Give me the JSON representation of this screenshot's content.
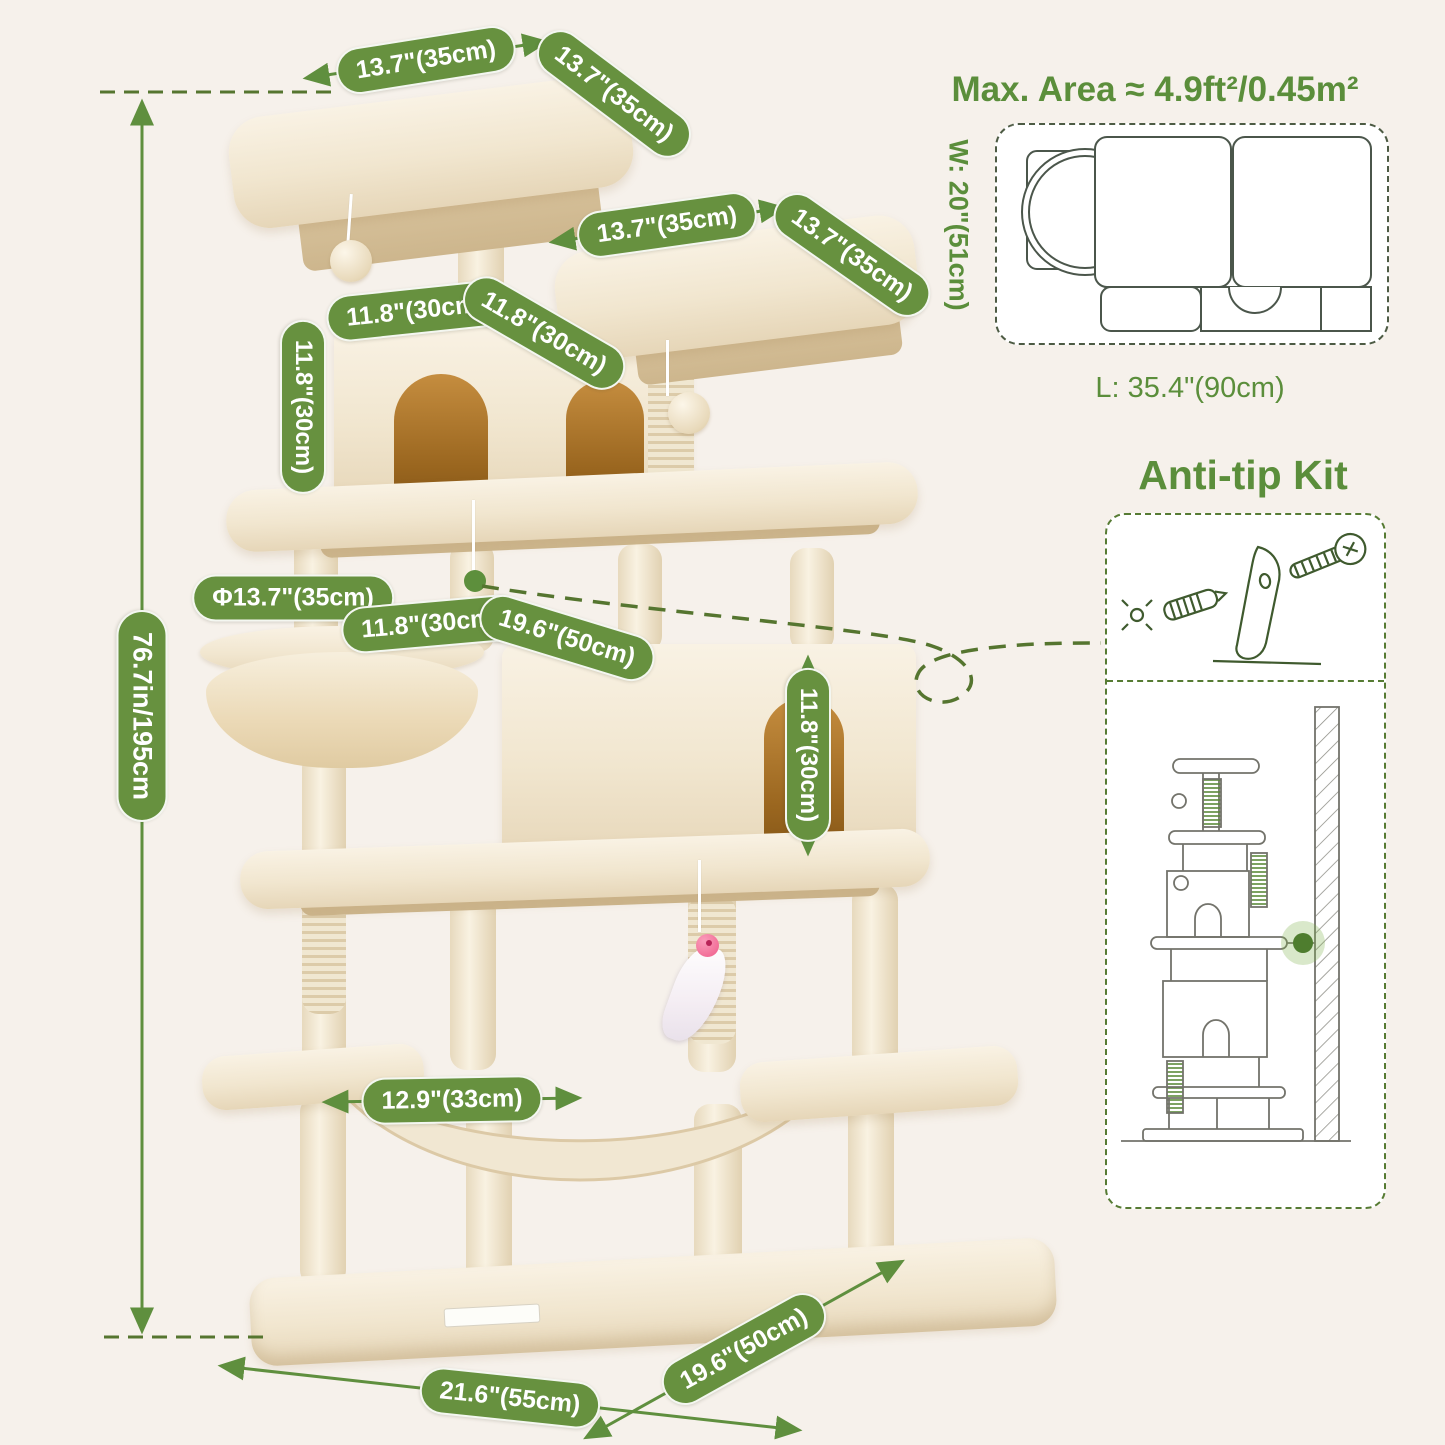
{
  "colors": {
    "background": "#f6f1eb",
    "accent_green": "#5b8e3b",
    "pill_green": "#67913f",
    "arrow_green": "#5f8f3e",
    "dash_green": "#55752f",
    "line_dark": "#4b564b",
    "plush": "#f4ecdb",
    "plush_shadow": "#e3d3b4",
    "interior_brown": "#a96e26",
    "sketch_gray": "#73736b"
  },
  "height_label": "76.7in/195cm",
  "dimension_pills": {
    "top_platform_length": "13.7\"(35cm)",
    "top_platform_width": "13.7\"(35cm)",
    "upper_platform_length": "13.7\"(35cm)",
    "upper_platform_width": "13.7\"(35cm)",
    "top_condo_width": "11.8\"(30cm)",
    "top_condo_depth": "11.8\"(30cm)",
    "top_condo_height": "11.8\"(30cm)",
    "basket_diameter": "Φ13.7\"(35cm)",
    "large_condo_width": "11.8\"(30cm)",
    "large_condo_length": "19.6\"(50cm)",
    "large_condo_height": "11.8\"(30cm)",
    "hammock_width": "12.9\"(33cm)",
    "base_length": "21.6\"(55cm)",
    "base_width": "19.6\"(50cm)"
  },
  "max_area": {
    "title": "Max. Area ≈ 4.9ft²/0.45m²",
    "width_label": "W: 20\"(51cm)",
    "length_label": "L: 35.4\"(90cm)"
  },
  "anti_tip": {
    "title": "Anti-tip Kit"
  }
}
